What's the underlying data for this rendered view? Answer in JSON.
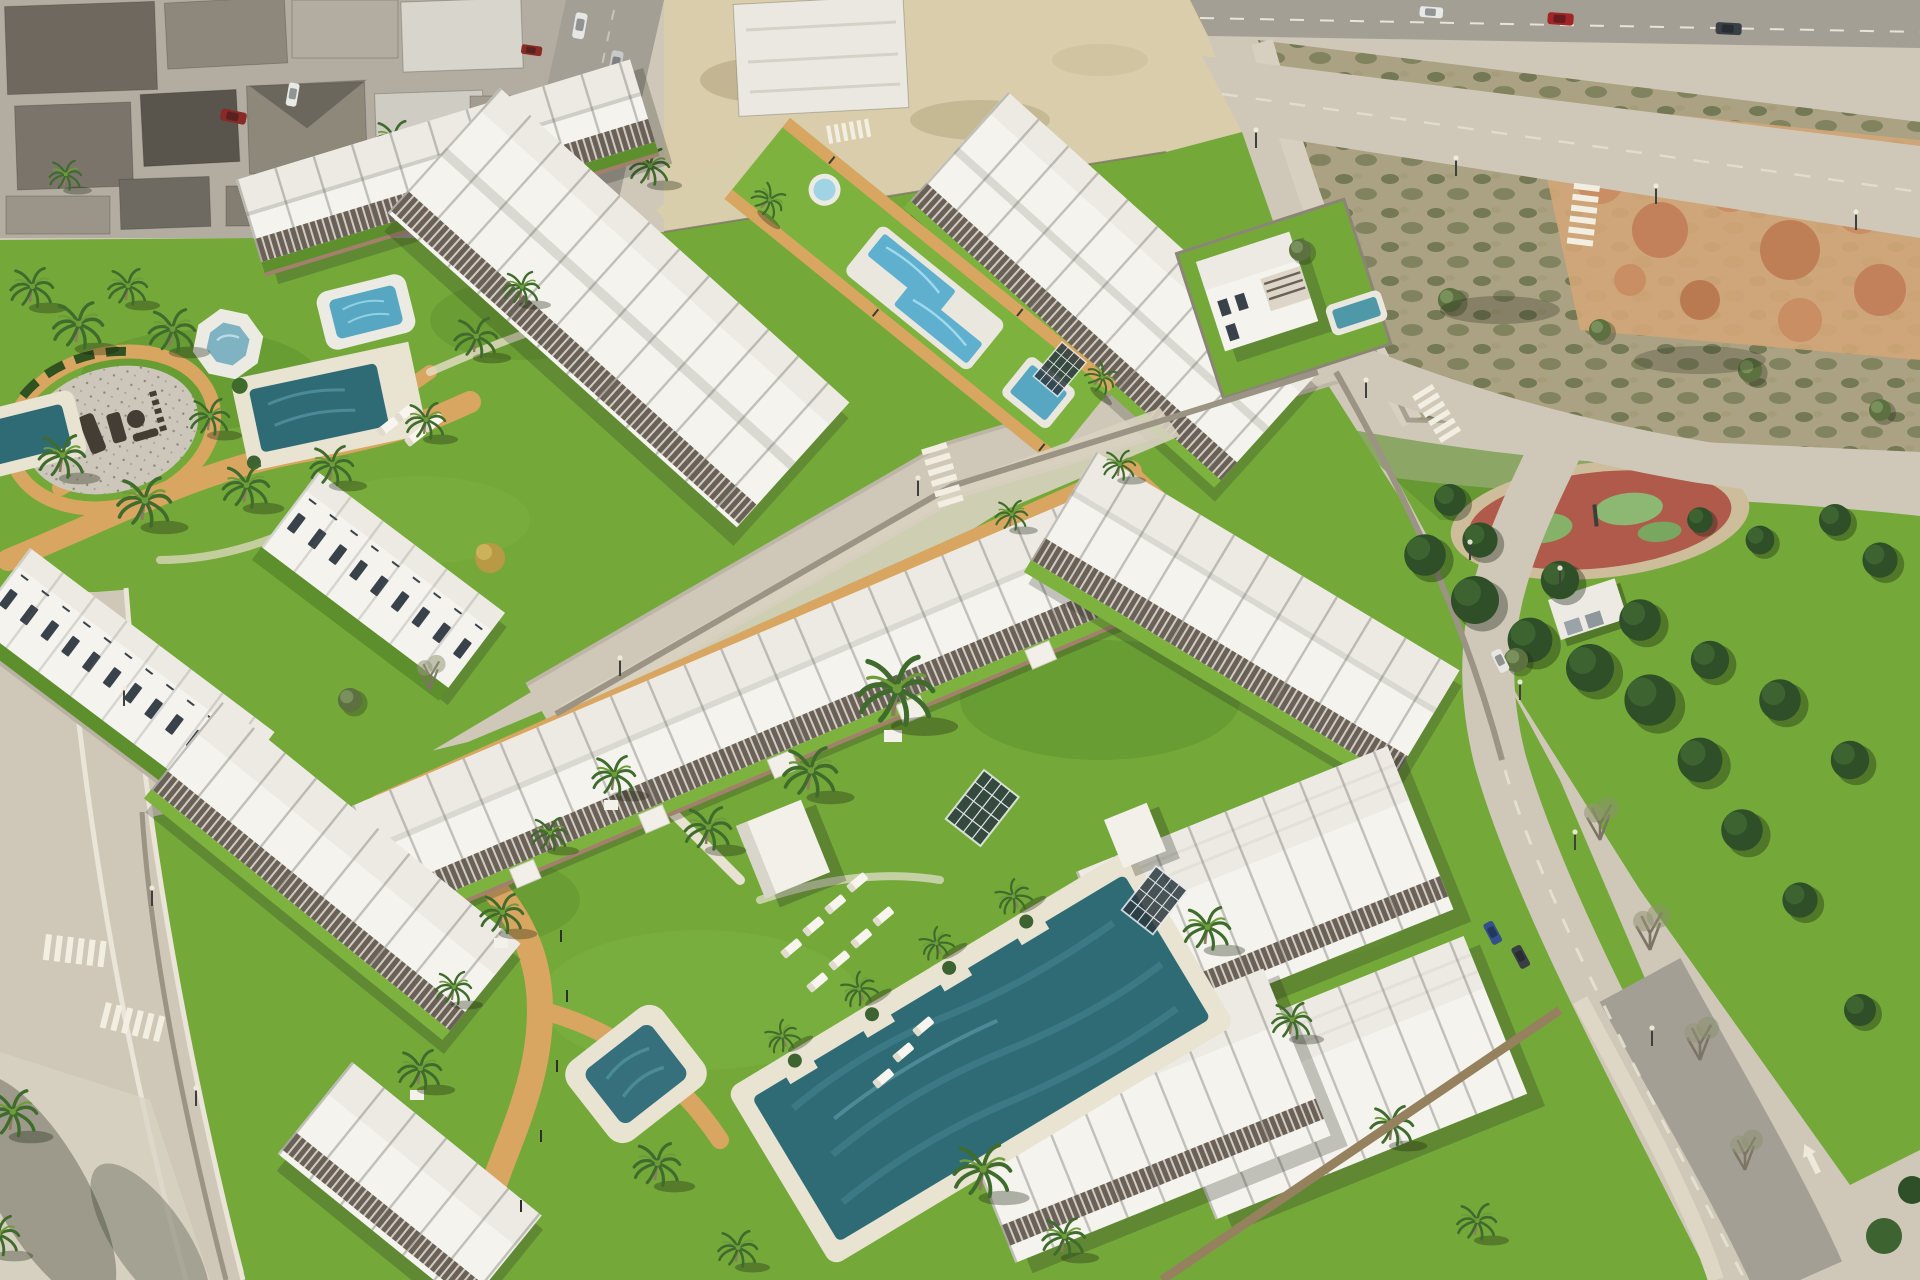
{
  "scene": {
    "description": "Aerial 3D architectural rendering of a white Mediterranean residential development with communal pools, lawns and palm trees, beside an existing town block, an empty scrubland plot, a pine-tree public park with a circular red playground, and surrounding streets with cars and zebra crossings.",
    "style": "photorealistic CGI aerial oblique view, bright daylight",
    "areas": {
      "old_town": {
        "label": "existing town block",
        "features": [
          "dense houses with grey and brown roofs",
          "street with parked cars",
          "big white building",
          "scattered palms"
        ]
      },
      "upper_complex": {
        "label": "upper townhouse complex",
        "rows": [
          "west row with pergola roof terraces",
          "central double row",
          "east row along pool strip",
          "two traditional white townhouse rows with dark windows"
        ],
        "garden": {
          "label": "west communal garden",
          "features": [
            "circular logo plaza with dark brand lettering (only '…LLAGE' partly legible)",
            "octagonal white spa",
            "rounded-square plunge pool",
            "family pool with palm planters and sun loungers",
            "corner pool at image edge",
            "winding sand-coloured paths",
            "many palm trees"
          ]
        },
        "pool_strip": {
          "label": "central communal pool lawn",
          "pools": [
            "round spa pool",
            "angled rectangular lap pool",
            "square plunge pool"
          ],
          "edges": "sand-coloured walkways with small light posts"
        }
      },
      "villa": {
        "label": "detached corner villa",
        "features": [
          "two storeys",
          "roof terrace",
          "private pool",
          "lawn"
        ]
      },
      "lower_complex": {
        "label": "lower apartment complex",
        "rows": [
          "long north row facing the courtyard",
          "west wing",
          "east wing",
          "large south-east blocks"
        ],
        "courtyard": {
          "label": "main courtyard",
          "features": [
            "large angled swimming pool with palm planters",
            "small rounded plunge pool",
            "two groups of white sun loungers",
            "white pool kiosk cubes",
            "glass canopies",
            "winding sand paths",
            "tall palms on white bases"
          ]
        }
      },
      "park": {
        "label": "public park",
        "features": [
          "dense pine trees",
          "circular playground with red safety surface and green patches",
          "small white kiosk",
          "lawns",
          "street lamps"
        ]
      },
      "vacant_lot": {
        "label": "empty scrubland plot",
        "features": [
          "dry scrub vegetation",
          "perimeter access road",
          "orange earth mounds in the corner"
        ]
      },
      "roads": {
        "label": "surrounding streets",
        "features": [
          "top avenue with cars",
          "wide avenue past the plot",
          "street along the park curving to the bottom-right corner",
          "west street with two zebra crossings",
          "middle street between the two complexes",
          "white lane arrow marking",
          "bare street trees",
          "stone boundary walls"
        ]
      },
      "vehicles": [
        "red car on top avenue",
        "white car",
        "dark cars",
        "parked cars along the old-town street",
        "cars on the east street"
      ]
    }
  },
  "palette": {
    "grass": "#74a93a",
    "grassBright": "#7db23f",
    "grassDark": "#5d8f2d",
    "path": "#d8a660",
    "sandDeck": "#e9e3d2",
    "roadLight": "#cfc8b8",
    "asphalt": "#a39f95",
    "sand": "#d9cdab",
    "lot": "#aba283",
    "dirtOrange": "#c98e63",
    "bldgWhite": "#f4f3ee",
    "roofLight": "#eceae3",
    "roofMid": "#d9d8d1",
    "pergola": "#6b6156",
    "poolDeep": "#2e6b74",
    "poolMid": "#4f98a8",
    "poolBright": "#5fb0cf",
    "treeDark": "#2e4f28",
    "treeMid": "#3c6330",
    "palmGreen": "#3f6b2c",
    "olive": "#5c7040",
    "wallStone": "#9b9384",
    "brick": "#a3806c",
    "townRoof": "#6a655c"
  }
}
